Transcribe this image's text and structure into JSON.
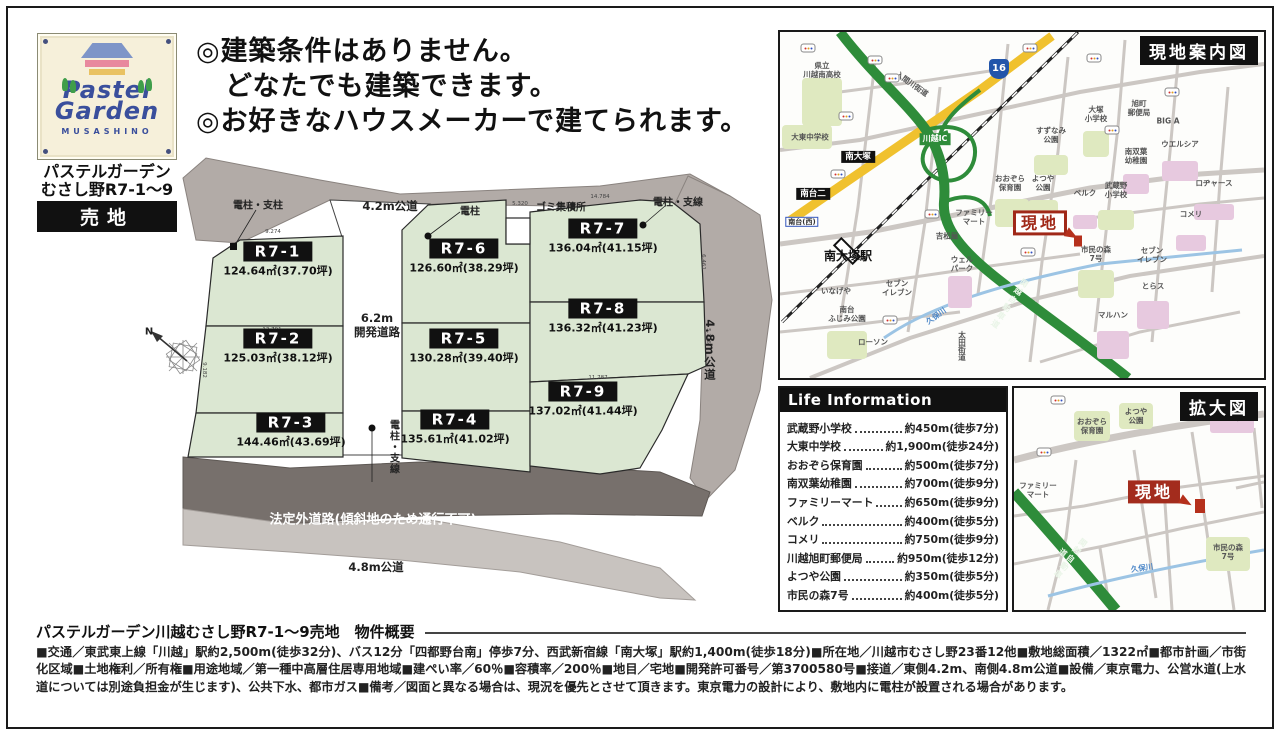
{
  "logo": {
    "brand_line1": "Pastel",
    "brand_line2": "Garden",
    "sub": "MUSASHINO",
    "name_line1": "パステルガーデン",
    "name_line2": "むさし野R7-1～9",
    "badge": "売地",
    "colors": {
      "navy": "#3a4f9c",
      "roof": "#7e95c8",
      "pink": "#e8899e",
      "yellow": "#e9c262",
      "tree": "#3f9e4a",
      "plate": "#f6f0da"
    }
  },
  "headline": {
    "lines": [
      "◎建築条件はありません。",
      "どなたでも建築できます。",
      "◎お好きなハウスメーカーで建てられます。"
    ]
  },
  "siteplan": {
    "plots": [
      {
        "id": "R7-1",
        "area": "124.64㎡(37.70坪)",
        "x": 278,
        "y": 260
      },
      {
        "id": "R7-2",
        "area": "125.03㎡(38.12坪)",
        "x": 278,
        "y": 347
      },
      {
        "id": "R7-3",
        "area": "144.46㎡(43.69坪)",
        "x": 291,
        "y": 431
      },
      {
        "id": "R7-4",
        "area": "135.61㎡(41.02坪)",
        "x": 455,
        "y": 428
      },
      {
        "id": "R7-5",
        "area": "130.28㎡(39.40坪)",
        "x": 464,
        "y": 347
      },
      {
        "id": "R7-6",
        "area": "126.60㎡(38.29坪)",
        "x": 464,
        "y": 257
      },
      {
        "id": "R7-7",
        "area": "136.04㎡(41.15坪)",
        "x": 603,
        "y": 237
      },
      {
        "id": "R7-8",
        "area": "136.32㎡(41.23坪)",
        "x": 603,
        "y": 317
      },
      {
        "id": "R7-9",
        "area": "137.02㎡(41.44坪)",
        "x": 583,
        "y": 400
      }
    ],
    "labels": [
      {
        "t": "電柱・支柱",
        "c": "sp-small",
        "x": 258,
        "y": 204,
        "n": "pole-label"
      },
      {
        "t": "4.2m公道",
        "c": "sp-road",
        "x": 390,
        "y": 207,
        "n": "road-42m-label"
      },
      {
        "t": "電柱",
        "c": "sp-small",
        "x": 470,
        "y": 210,
        "n": "pole-label"
      },
      {
        "t": "ゴミ集積所",
        "c": "sp-small",
        "x": 561,
        "y": 206,
        "n": "garbage-station-label"
      },
      {
        "t": "電柱・支線",
        "c": "sp-small",
        "x": 678,
        "y": 201,
        "n": "pole-label"
      },
      {
        "t": "6.2m\n開発道路",
        "c": "sp-road",
        "x": 377,
        "y": 326,
        "n": "dev-road-label"
      },
      {
        "t": "4.8m公道",
        "c": "sp-road sp-vert",
        "x": 709,
        "y": 350,
        "n": "road-48m-east-label"
      },
      {
        "t": "電柱・支線",
        "c": "sp-small sp-vert",
        "x": 393,
        "y": 447,
        "n": "pole-label"
      },
      {
        "t": "法定外道路(傾斜地のため通行不可)",
        "c": "sp-white",
        "x": 373,
        "y": 518,
        "n": "non-statutory-road-label"
      },
      {
        "t": "4.8m公道",
        "c": "sp-road",
        "x": 376,
        "y": 568,
        "n": "road-48m-south-label"
      },
      {
        "t": "N",
        "c": "sp-small",
        "x": 149,
        "y": 332,
        "n": "compass-north-label"
      }
    ],
    "dims": [
      {
        "t": "9.274",
        "x": 138,
        "y": 85
      },
      {
        "t": "13.791",
        "x": 137,
        "y": 183
      },
      {
        "t": "9.182",
        "x": 68,
        "y": 222,
        "r": 90
      },
      {
        "t": "13.066",
        "x": 133,
        "y": 271
      },
      {
        "t": "12.444",
        "x": 320,
        "y": 269
      },
      {
        "t": "13.748",
        "x": 465,
        "y": 159
      },
      {
        "t": "11.787",
        "x": 463,
        "y": 231
      },
      {
        "t": "6.461",
        "x": 567,
        "y": 114,
        "r": 90
      },
      {
        "t": "5.726",
        "x": 572,
        "y": 188,
        "r": 90
      },
      {
        "t": "5.320",
        "x": 385,
        "y": 57
      },
      {
        "t": "14.784",
        "x": 465,
        "y": 50
      }
    ]
  },
  "map_guide": {
    "title": "現地案内図",
    "items": [
      {
        "c": "m-ag",
        "x": 42,
        "y": 70,
        "w": 40,
        "h": 48,
        "n": "school-area"
      },
      {
        "c": "m-ag",
        "x": 27,
        "y": 105,
        "w": 50,
        "h": 24,
        "n": "school-area"
      },
      {
        "c": "m-ag",
        "x": 316,
        "y": 112,
        "w": 26,
        "h": 26,
        "n": "school-area"
      },
      {
        "c": "m-ag",
        "x": 271,
        "y": 133,
        "w": 34,
        "h": 20,
        "n": "park-area"
      },
      {
        "c": "m-ap",
        "x": 400,
        "y": 139,
        "w": 36,
        "h": 20,
        "n": "store-area"
      },
      {
        "c": "m-ap",
        "x": 356,
        "y": 152,
        "w": 26,
        "h": 20,
        "n": "kindergarten-area"
      },
      {
        "c": "m-ap",
        "x": 434,
        "y": 180,
        "w": 40,
        "h": 16,
        "n": "store-area"
      },
      {
        "c": "m-ag",
        "x": 263,
        "y": 181,
        "w": 30,
        "h": 26,
        "n": "park-area"
      },
      {
        "c": "m-ag",
        "x": 232,
        "y": 181,
        "w": 34,
        "h": 28,
        "n": "nursery-area"
      },
      {
        "c": "m-ap",
        "x": 305,
        "y": 190,
        "w": 24,
        "h": 14,
        "n": "store-area"
      },
      {
        "c": "m-ag",
        "x": 336,
        "y": 188,
        "w": 36,
        "h": 20,
        "n": "school-area"
      },
      {
        "c": "m-ap",
        "x": 411,
        "y": 211,
        "w": 30,
        "h": 16,
        "n": "store-area"
      },
      {
        "c": "m-ag",
        "x": 316,
        "y": 252,
        "w": 36,
        "h": 28,
        "n": "forest-area"
      },
      {
        "c": "m-ap",
        "x": 373,
        "y": 283,
        "w": 32,
        "h": 28,
        "n": "store-area"
      },
      {
        "c": "m-ap",
        "x": 333,
        "y": 313,
        "w": 32,
        "h": 28,
        "n": "store-area"
      },
      {
        "c": "m-ap",
        "x": 180,
        "y": 260,
        "w": 24,
        "h": 32,
        "n": "store-area"
      },
      {
        "c": "m-ag",
        "x": 67,
        "y": 313,
        "w": 40,
        "h": 28,
        "n": "park-area"
      },
      {
        "t": "県立\n川越南高校",
        "x": 42,
        "y": 38,
        "n": "kawagoe-minami-hs-label"
      },
      {
        "t": "大東中学校",
        "x": 30,
        "y": 105,
        "n": "daito-jhs-label"
      },
      {
        "t": "入間川街道",
        "x": 132,
        "y": 52,
        "r": 35,
        "n": "irumagawa-kaido-label"
      },
      {
        "c": "m-gbox",
        "t": "川越IC",
        "x": 155,
        "y": 107,
        "n": "kawagoe-ic-label"
      },
      {
        "c": "m-shield",
        "t": "16",
        "x": 219,
        "y": 37,
        "n": "route16-shield"
      },
      {
        "t": "大塚\n小学校",
        "x": 316,
        "y": 82,
        "n": "otsuka-es-label"
      },
      {
        "t": "旭町\n郵便局",
        "x": 359,
        "y": 76,
        "n": "asahicho-postoffice-label"
      },
      {
        "t": "BIG A",
        "x": 388,
        "y": 89,
        "n": "big-a-label"
      },
      {
        "t": "ウエルシア",
        "x": 400,
        "y": 112,
        "n": "welcia-label"
      },
      {
        "t": "南双葉\n幼稚園",
        "x": 356,
        "y": 124,
        "n": "minamifutaba-kg-label"
      },
      {
        "t": "すずなみ\n公園",
        "x": 271,
        "y": 103,
        "n": "suzunami-park-label"
      },
      {
        "t": "ロヂャース",
        "x": 434,
        "y": 151,
        "n": "rogers-label"
      },
      {
        "t": "よつや\n公園",
        "x": 263,
        "y": 151,
        "n": "yotsuya-park-label"
      },
      {
        "t": "おおぞら\n保育園",
        "x": 230,
        "y": 151,
        "n": "ozora-nursery-label"
      },
      {
        "t": "ベルク",
        "x": 305,
        "y": 161,
        "n": "belc-label"
      },
      {
        "t": "武蔵野\n小学校",
        "x": 336,
        "y": 158,
        "n": "musashino-es-label"
      },
      {
        "t": "コメリ",
        "x": 411,
        "y": 182,
        "n": "komeri-label"
      },
      {
        "c": "m-genchi-o",
        "t": "現地",
        "x": 260,
        "y": 191,
        "n": "site-marker"
      },
      {
        "c": "m-arrow",
        "x": 292,
        "y": 203,
        "r": 30,
        "n": "site-arrow"
      },
      {
        "c": "m-spot",
        "x": 298,
        "y": 209,
        "w": 8,
        "h": 11,
        "n": "site-spot"
      },
      {
        "t": "市民の森\n7号",
        "x": 316,
        "y": 222,
        "n": "shimin-no-mori-label"
      },
      {
        "t": "セブン\nイレブン",
        "x": 372,
        "y": 223,
        "n": "seven-eleven-label"
      },
      {
        "t": "とらス",
        "x": 373,
        "y": 254,
        "n": "torasu-label"
      },
      {
        "t": "マルハン",
        "x": 333,
        "y": 283,
        "n": "maruhan-label"
      },
      {
        "t": "ファミリー\nマート",
        "x": 194,
        "y": 185,
        "n": "familymart-label"
      },
      {
        "t": "吉松屋",
        "x": 167,
        "y": 204,
        "n": "yoshimatsuya-label"
      },
      {
        "t": "ウェル\nパーク",
        "x": 182,
        "y": 232,
        "n": "welpark-label"
      },
      {
        "t": "いなげや",
        "x": 56,
        "y": 259,
        "n": "inageya-label"
      },
      {
        "t": "セブン\nイレブン",
        "x": 117,
        "y": 256,
        "n": "seven-eleven-label"
      },
      {
        "t": "南台\nふじみ公園",
        "x": 67,
        "y": 282,
        "n": "fujimi-park-label"
      },
      {
        "t": "ローソン",
        "x": 93,
        "y": 310,
        "n": "lawson-label"
      },
      {
        "c": "m-river",
        "t": "久保川",
        "x": 156,
        "y": 284,
        "r": -35,
        "n": "kubo-river-label"
      },
      {
        "c": "mi m-vert",
        "t": "太田街道",
        "x": 182,
        "y": 314,
        "n": "ota-kaido-label"
      },
      {
        "c": "m-roadlb m-vert",
        "t": "関越自動車道",
        "x": 229,
        "y": 272,
        "r": 35,
        "n": "kanetsu-expressway-label"
      },
      {
        "c": "m-bbox",
        "t": "南大塚",
        "x": 78,
        "y": 125,
        "n": "minami-otsuka-label"
      },
      {
        "c": "m-bbox",
        "t": "南台二",
        "x": 33,
        "y": 162,
        "n": "minamidai-2-label"
      },
      {
        "c": "m-bluebox",
        "t": "南台(西)",
        "x": 22,
        "y": 190,
        "n": "minamidai-west-label"
      },
      {
        "c": "m-station",
        "t": "南大塚駅",
        "x": 68,
        "y": 224,
        "n": "minami-otsuka-station-label"
      },
      {
        "c": "m-bus",
        "x": 28,
        "y": 16,
        "n": "bus-stop-icon"
      },
      {
        "c": "m-bus",
        "x": 95,
        "y": 28,
        "n": "bus-stop-icon"
      },
      {
        "c": "m-bus",
        "x": 112,
        "y": 46,
        "n": "bus-stop-icon"
      },
      {
        "c": "m-bus",
        "x": 66,
        "y": 84,
        "n": "bus-stop-icon"
      },
      {
        "c": "m-bus",
        "x": 250,
        "y": 16,
        "n": "bus-stop-icon"
      },
      {
        "c": "m-bus",
        "x": 314,
        "y": 26,
        "n": "bus-stop-icon"
      },
      {
        "c": "m-bus",
        "x": 392,
        "y": 60,
        "n": "bus-stop-icon"
      },
      {
        "c": "m-bus",
        "x": 332,
        "y": 98,
        "n": "bus-stop-icon"
      },
      {
        "c": "m-bus",
        "x": 58,
        "y": 142,
        "n": "bus-stop-icon"
      },
      {
        "c": "m-bus",
        "x": 152,
        "y": 182,
        "n": "bus-stop-icon"
      },
      {
        "c": "m-bus",
        "x": 248,
        "y": 220,
        "n": "bus-stop-icon"
      },
      {
        "c": "m-bus",
        "x": 110,
        "y": 288,
        "n": "bus-stop-icon"
      }
    ]
  },
  "life_info": {
    "title": "Life Information",
    "rows": [
      {
        "label": "武蔵野小学校",
        "value": "約450m(徒歩7分)"
      },
      {
        "label": "大東中学校",
        "value": "約1,900m(徒歩24分)"
      },
      {
        "label": "おおぞら保育園",
        "value": "約500m(徒歩7分)"
      },
      {
        "label": "南双葉幼稚園",
        "value": "約700m(徒歩9分)"
      },
      {
        "label": "ファミリーマート",
        "value": "約650m(徒歩9分)"
      },
      {
        "label": "ベルク",
        "value": "約400m(徒歩5分)"
      },
      {
        "label": "コメリ",
        "value": "約750m(徒歩9分)"
      },
      {
        "label": "川越旭町郵便局",
        "value": "約950m(徒歩12分)"
      },
      {
        "label": "よつや公園",
        "value": "約350m(徒歩5分)"
      },
      {
        "label": "市民の森7号",
        "value": "約400m(徒歩5分)"
      }
    ]
  },
  "map_zoom": {
    "title": "拡大図",
    "items": [
      {
        "c": "m-ag",
        "x": 78,
        "y": 38,
        "w": 36,
        "h": 30,
        "n": "nursery-area"
      },
      {
        "c": "m-ag",
        "x": 122,
        "y": 28,
        "w": 34,
        "h": 26,
        "n": "park-area"
      },
      {
        "c": "m-ap",
        "x": 218,
        "y": 30,
        "w": 44,
        "h": 30,
        "n": "store-area"
      },
      {
        "c": "m-ag",
        "x": 214,
        "y": 166,
        "w": 44,
        "h": 34,
        "n": "forest-area"
      },
      {
        "t": "おおぞら\n保育園",
        "x": 78,
        "y": 38,
        "n": "ozora-nursery-label"
      },
      {
        "t": "よつや\n公園",
        "x": 122,
        "y": 28,
        "n": "yotsuya-park-label"
      },
      {
        "t": "ベルク",
        "x": 218,
        "y": 30,
        "n": "belc-label"
      },
      {
        "t": "ファミリー\nマート",
        "x": 24,
        "y": 102,
        "n": "familymart-label"
      },
      {
        "c": "m-genchi-s",
        "t": "現地",
        "x": 140,
        "y": 104,
        "n": "site-marker"
      },
      {
        "c": "m-arrow",
        "x": 172,
        "y": 114,
        "r": 30,
        "n": "site-arrow"
      },
      {
        "c": "m-spot",
        "x": 186,
        "y": 118,
        "w": 10,
        "h": 14,
        "n": "site-spot"
      },
      {
        "t": "市民の森\n7号",
        "x": 214,
        "y": 164,
        "n": "shimin-no-mori-label"
      },
      {
        "c": "m-river",
        "t": "久保川",
        "x": 128,
        "y": 180,
        "r": -8,
        "n": "kubo-river-label"
      },
      {
        "c": "m-roadlb m-vert",
        "t": "関越自動車道",
        "x": 52,
        "y": 168,
        "r": 38,
        "n": "kanetsu-expressway-label"
      },
      {
        "c": "m-bus",
        "x": 44,
        "y": 12,
        "n": "bus-stop-icon"
      },
      {
        "c": "m-bus",
        "x": 30,
        "y": 64,
        "n": "bus-stop-icon"
      }
    ]
  },
  "overview": {
    "title": "パステルガーデン川越むさし野R7-1～9売地　物件概要",
    "body": "■交通／東武東上線「川越」駅約2,500m(徒歩32分)、バス12分「四都野台南」停歩7分、西武新宿線「南大塚」駅約1,400m(徒歩18分)■所在地／川越市むさし野23番12他■敷地総面積／1322㎡■都市計画／市街化区域■土地権利／所有権■用途地域／第一種中高層住居専用地域■建ぺい率／60％■容積率／200％■地目／宅地■開発許可番号／第3700580号■接道／東側4.2m、南側4.8m公道■設備／東京電力、公営水道(上水道については別途負担金が生じます)、公共下水、都市ガス■備考／図面と異なる場合は、現況を優先とさせて頂きます。東京電力の設計により、敷地内に電柱が設置される場合があります。"
  }
}
